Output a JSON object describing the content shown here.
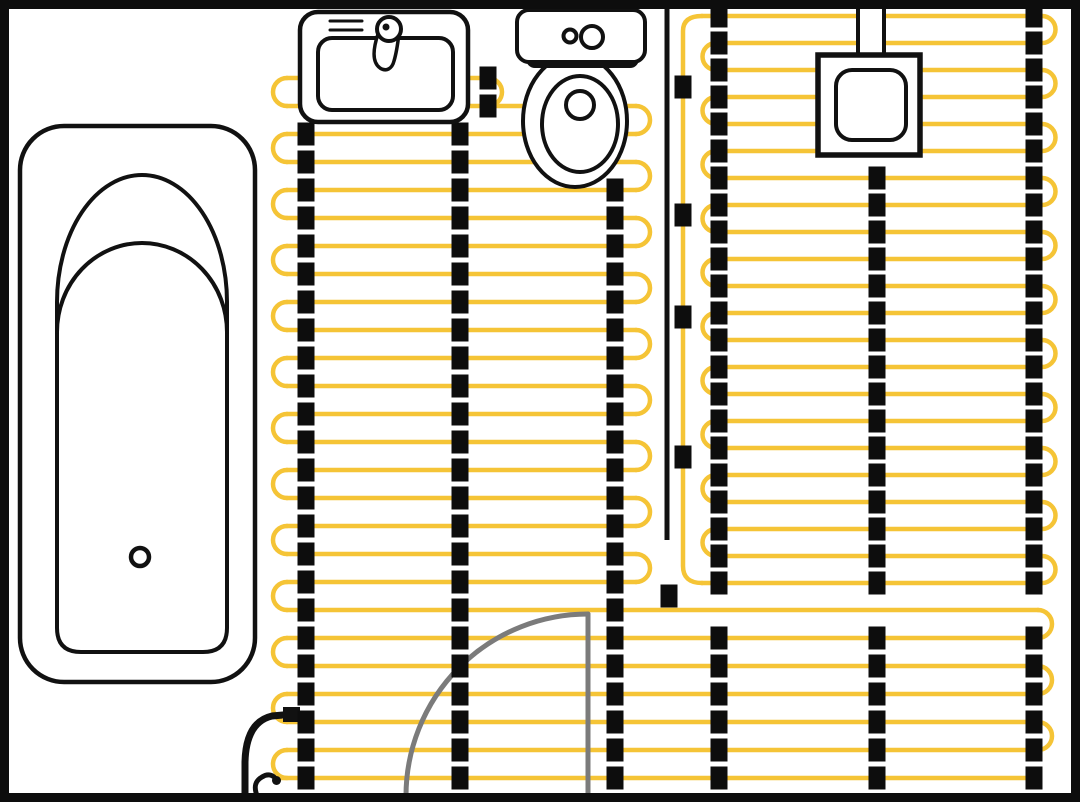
{
  "diagram": {
    "title": "bathroom-underfloor-heating-plan",
    "canvas": {
      "width": 1080,
      "height": 802,
      "wall_thickness": 9,
      "wall_color": "#0d0d0d",
      "background": "#ffffff"
    },
    "colors": {
      "heating_cable": "#F5C436",
      "fixing_clip": "#0d0d0d",
      "fixture_outline": "#111111",
      "door": "#7b7b7b",
      "fixture_fill": "#ffffff"
    },
    "heating_cable": {
      "stroke_width": 4.5,
      "left_zone": {
        "row_start_y": 78,
        "pitch": 28,
        "upper_row_count": 20,
        "bottom_row_count": 6,
        "row_x_left": 287,
        "row_x_right": 636,
        "turn_radius": 14,
        "turn_apex_left": 273,
        "turn_apex_right": 650,
        "bottom_row_x_right": 1038,
        "first_row_x_right": 488,
        "first_row_turn_apex": 502,
        "last_row_x_left": 280
      },
      "right_zone": {
        "row_start_y": 16,
        "pitch": 27,
        "row_count": 22,
        "row_x_left": 716,
        "row_x_right": 1042,
        "turn_radius": 13.5,
        "feed_join_x": 702
      },
      "feed_line": {
        "path": "M 702,583 Q 683,583 683,566 L 683,31 Q 683,16 702,16"
      }
    },
    "fixing_clips": {
      "width": 17,
      "height": 23,
      "columns": [
        {
          "x": 306,
          "zone": "left",
          "first": 134,
          "last": 778
        },
        {
          "x": 460,
          "zone": "left",
          "first": 134,
          "last": 778
        },
        {
          "x": 615,
          "zone": "left",
          "first": 190,
          "last": 778
        },
        {
          "x": 488,
          "zone": "left",
          "first": 78,
          "last": 106
        },
        {
          "x": 719,
          "zone": "right",
          "first": 16,
          "last": 778
        },
        {
          "x": 877,
          "zone": "right",
          "first": 178,
          "last": 778
        },
        {
          "x": 1034,
          "zone": "right",
          "first": 16,
          "last": 778
        }
      ],
      "free_clips": [
        [
          683,
          87
        ],
        [
          683,
          215
        ],
        [
          683,
          317
        ],
        [
          683,
          457
        ],
        [
          669,
          596
        ]
      ]
    },
    "zone_divider": {
      "x": 667,
      "y1": 9,
      "y2": 540,
      "width": 5
    },
    "leads": {
      "power_lead": {
        "path": "M 245,798 L 245,762 Q 246,722 272,716 L 283,715",
        "width": 7,
        "tip_rect": [
          283,
          707,
          17,
          15
        ]
      },
      "sensor_lead": {
        "path": "M 258,798 C 253,787 255,781 262,777 C 268,773 274,775 276,780",
        "width": 5,
        "tip_dot": [
          276.5,
          780.5,
          4.5
        ]
      }
    },
    "door": {
      "leaf_path": "M 588,614 L 588,796",
      "swing_arc_path": "M 588,614 A 182,182 0 0 0 406,796",
      "stroke_width": 5
    },
    "bathtub": {
      "shapes": [
        {
          "t": "rrect",
          "x": 20,
          "y": 126,
          "w": 235,
          "h": 556,
          "r": 44,
          "sw": 4.5
        },
        {
          "t": "path",
          "d": "M 57,302 A 85,127 0 0 1 227,302 L 227,628 Q 227,652 203,652 L 81,652 Q 57,652 57,628 Z",
          "sw": 4
        },
        {
          "t": "path",
          "d": "M 57,332 A 85,89 0 0 1 227,332",
          "sw": 4,
          "fill": "none"
        },
        {
          "t": "circle",
          "cx": 140,
          "cy": 557,
          "r": 9,
          "sw": 4.5
        }
      ]
    },
    "sink": {
      "shapes": [
        {
          "t": "rrect",
          "x": 300,
          "y": 12,
          "w": 168,
          "h": 110,
          "r": 18,
          "sw": 4.5
        },
        {
          "t": "rrect",
          "x": 318,
          "y": 38,
          "w": 135,
          "h": 72,
          "r": 14,
          "sw": 4
        },
        {
          "t": "line",
          "x1": 330,
          "y1": 21,
          "x2": 362,
          "y2": 21,
          "sw": 3
        },
        {
          "t": "line",
          "x1": 330,
          "y1": 30,
          "x2": 362,
          "y2": 30,
          "sw": 3
        },
        {
          "t": "path",
          "d": "M 378,34 C 372,52 373,63 380,68 C 386,72 392,69 394,61 C 397,51 398,42 399,33",
          "sw": 3.5
        },
        {
          "t": "circle",
          "cx": 389,
          "cy": 29,
          "r": 12,
          "sw": 4
        },
        {
          "t": "dot",
          "cx": 386,
          "cy": 27,
          "r": 3.5
        }
      ]
    },
    "toilet": {
      "shapes": [
        {
          "t": "ellipse",
          "cx": 575,
          "cy": 121,
          "rx": 52,
          "ry": 66,
          "sw": 4
        },
        {
          "t": "ellipse",
          "cx": 580,
          "cy": 124,
          "rx": 38,
          "ry": 48,
          "sw": 4,
          "fill": "none"
        },
        {
          "t": "circle",
          "cx": 580,
          "cy": 105,
          "r": 14,
          "sw": 4
        },
        {
          "t": "rrect",
          "x": 528,
          "y": 48,
          "w": 109,
          "h": 18,
          "r": 7,
          "sw": 4
        },
        {
          "t": "rrect",
          "x": 517,
          "y": 10,
          "w": 128,
          "h": 52,
          "r": 12,
          "sw": 4
        },
        {
          "t": "circle",
          "cx": 570,
          "cy": 36,
          "r": 6.5,
          "sw": 4,
          "fill": "none"
        },
        {
          "t": "circle",
          "cx": 592,
          "cy": 37,
          "r": 11,
          "sw": 4,
          "fill": "none"
        }
      ]
    },
    "junction_box": {
      "shapes": [
        {
          "t": "rect",
          "x": 858,
          "y": 2,
          "w": 26,
          "h": 56,
          "sw": 4
        },
        {
          "t": "rect",
          "x": 818,
          "y": 55,
          "w": 102,
          "h": 100,
          "sw": 5.5
        },
        {
          "t": "rrect",
          "x": 836,
          "y": 70,
          "w": 70,
          "h": 70,
          "r": 16,
          "sw": 4
        }
      ]
    }
  }
}
